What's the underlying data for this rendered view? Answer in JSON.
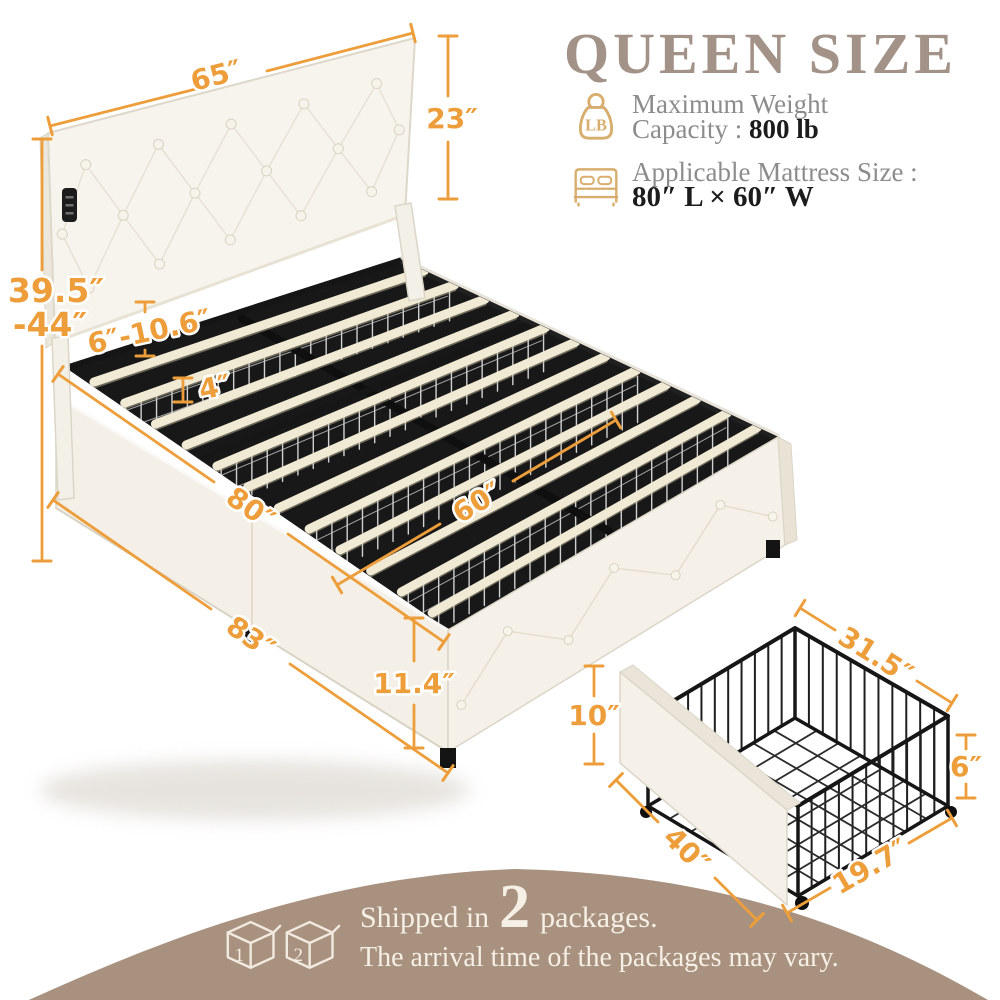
{
  "title": "QUEEN SIZE",
  "features": {
    "weight": {
      "icon_text": "LB",
      "line1": "Maximum Weight",
      "line2_label": "Capacity :",
      "line2_value": "800 lb"
    },
    "mattress": {
      "line1": "Applicable Mattress Size :",
      "line2_value": "80″ L × 60″ W"
    }
  },
  "dimensions": {
    "headboard_width": "65″",
    "headboard_height": "23″",
    "floor_to_headboard_top_line1": "39.5″",
    "floor_to_headboard_top_line2": "-44″",
    "headboard_clearance": "6″-10.6″",
    "slat_spacing": "4″",
    "bed_length": "80″",
    "bed_width": "60″",
    "overall_length": "83″",
    "base_height": "11.4″",
    "drawer_front_height": "10″",
    "drawer_front_width": "40″",
    "drawer_depth": "31.5″",
    "drawer_basket_height": "6″",
    "drawer_basket_width": "19.7″"
  },
  "footer": {
    "box1_label": "1",
    "box2_label": "2",
    "shipped_prefix": "Shipped in",
    "package_count": "2",
    "shipped_suffix": "packages.",
    "note": "The arrival time of the packages may vary."
  },
  "colors": {
    "accent_orange": "#ED9E3B",
    "title_taupe": "#A39288",
    "icon_gold": "#D8AE6E",
    "hill_taupe": "#A8927F",
    "text_gray": "#8C8C8C",
    "text_dark": "#1C1C1C",
    "upholstery": "#F6F3EC",
    "slat_cream": "#F0E9D3",
    "metal_black": "#1B1B1B"
  }
}
